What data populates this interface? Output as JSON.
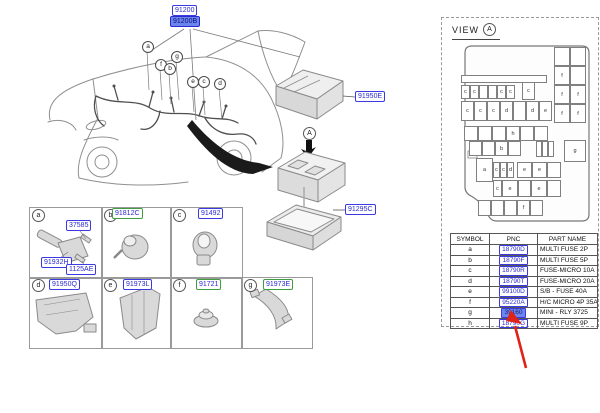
{
  "diagram": {
    "labels": {
      "main": "91200",
      "main_sub": "91200B",
      "main_sub_selected": true,
      "cover": "91950E",
      "lower_cover": "91295C"
    },
    "view_marker": "A",
    "car_callouts": [
      "a",
      "f",
      "b",
      "g",
      "e",
      "c",
      "d"
    ]
  },
  "parts_grid": {
    "cells": [
      {
        "letter": "a",
        "labels": [
          "37585",
          "91932H",
          "1125AE"
        ],
        "green": false
      },
      {
        "letter": "b",
        "labels": [
          "91812C"
        ],
        "green": true
      },
      {
        "letter": "c",
        "labels": [
          "91492"
        ],
        "green": false
      },
      {
        "letter": "d",
        "labels": [
          "91950Q"
        ],
        "green": false
      },
      {
        "letter": "e",
        "labels": [
          "91973L"
        ],
        "green": false
      },
      {
        "letter": "f",
        "labels": [
          "91721"
        ],
        "green": true
      },
      {
        "letter": "g",
        "labels": [
          "91973E"
        ],
        "green": true
      }
    ]
  },
  "view_panel": {
    "title": "VIEW",
    "marker": "A",
    "table": {
      "headers": [
        "SYMBOL",
        "PNC",
        "PART NAME"
      ],
      "rows": [
        {
          "symbol": "a",
          "pnc": "18790D",
          "part_name": "MULTI FUSE 2P",
          "selected": false
        },
        {
          "symbol": "b",
          "pnc": "18790F",
          "part_name": "MULTI FUSE 5P",
          "selected": false
        },
        {
          "symbol": "c",
          "pnc": "18790R",
          "part_name": "FUSE-MICRO 10A",
          "selected": false
        },
        {
          "symbol": "d",
          "pnc": "18790T",
          "part_name": "FUSE-MICRO 20A",
          "selected": false
        },
        {
          "symbol": "e",
          "pnc": "99100D",
          "part_name": "S/B - FUSE 40A",
          "selected": false
        },
        {
          "symbol": "f",
          "pnc": "95220A",
          "part_name": "H/C MICRO 4P 35A",
          "selected": false
        },
        {
          "symbol": "g",
          "pnc": "39160",
          "part_name": "MINI - RLY 3725",
          "selected": true
        },
        {
          "symbol": "h",
          "pnc": "18790G",
          "part_name": "MULTI FUSE 9P",
          "selected": false
        }
      ]
    },
    "fusebox": {
      "cells": [
        {
          "x": 100,
          "y": 2,
          "w": 16,
          "h": 19,
          "t": ""
        },
        {
          "x": 116,
          "y": 2,
          "w": 16,
          "h": 19,
          "t": ""
        },
        {
          "x": 100,
          "y": 21,
          "w": 16,
          "h": 19,
          "t": "f"
        },
        {
          "x": 116,
          "y": 21,
          "w": 16,
          "h": 19,
          "t": ""
        },
        {
          "x": 100,
          "y": 40,
          "w": 16,
          "h": 19,
          "t": "f"
        },
        {
          "x": 116,
          "y": 40,
          "w": 16,
          "h": 19,
          "t": "f"
        },
        {
          "x": 100,
          "y": 59,
          "w": 16,
          "h": 19,
          "t": "f"
        },
        {
          "x": 116,
          "y": 59,
          "w": 16,
          "h": 19,
          "t": "f"
        },
        {
          "x": 7,
          "y": 30,
          "w": 86,
          "h": 8,
          "t": ""
        },
        {
          "x": 7,
          "y": 40,
          "w": 9,
          "h": 14,
          "t": "c"
        },
        {
          "x": 16,
          "y": 40,
          "w": 9,
          "h": 14,
          "t": "c"
        },
        {
          "x": 25,
          "y": 40,
          "w": 9,
          "h": 14,
          "t": ""
        },
        {
          "x": 34,
          "y": 40,
          "w": 9,
          "h": 14,
          "t": ""
        },
        {
          "x": 43,
          "y": 40,
          "w": 9,
          "h": 14,
          "t": "c"
        },
        {
          "x": 52,
          "y": 40,
          "w": 9,
          "h": 14,
          "t": "c"
        },
        {
          "x": 68,
          "y": 37,
          "w": 13,
          "h": 18,
          "t": "c"
        },
        {
          "x": 7,
          "y": 56,
          "w": 13,
          "h": 20,
          "t": "c"
        },
        {
          "x": 20,
          "y": 56,
          "w": 13,
          "h": 20,
          "t": "c"
        },
        {
          "x": 33,
          "y": 56,
          "w": 13,
          "h": 20,
          "t": "c"
        },
        {
          "x": 46,
          "y": 56,
          "w": 13,
          "h": 20,
          "t": "d"
        },
        {
          "x": 59,
          "y": 56,
          "w": 13,
          "h": 20,
          "t": ""
        },
        {
          "x": 72,
          "y": 56,
          "w": 13,
          "h": 20,
          "t": "d"
        },
        {
          "x": 85,
          "y": 56,
          "w": 13,
          "h": 20,
          "t": "e"
        },
        {
          "x": 10,
          "y": 81,
          "w": 14,
          "h": 15,
          "t": ""
        },
        {
          "x": 24,
          "y": 81,
          "w": 14,
          "h": 15,
          "t": ""
        },
        {
          "x": 38,
          "y": 81,
          "w": 14,
          "h": 15,
          "t": ""
        },
        {
          "x": 52,
          "y": 81,
          "w": 14,
          "h": 15,
          "t": "h"
        },
        {
          "x": 66,
          "y": 81,
          "w": 14,
          "h": 15,
          "t": ""
        },
        {
          "x": 80,
          "y": 81,
          "w": 14,
          "h": 15,
          "t": ""
        },
        {
          "x": 15,
          "y": 96,
          "w": 13,
          "h": 15,
          "t": ""
        },
        {
          "x": 28,
          "y": 96,
          "w": 13,
          "h": 15,
          "t": ""
        },
        {
          "x": 41,
          "y": 96,
          "w": 13,
          "h": 15,
          "t": "b"
        },
        {
          "x": 54,
          "y": 96,
          "w": 13,
          "h": 15,
          "t": ""
        },
        {
          "x": 82,
          "y": 96,
          "w": 6,
          "h": 16,
          "t": ""
        },
        {
          "x": 88,
          "y": 96,
          "w": 6,
          "h": 16,
          "t": ""
        },
        {
          "x": 94,
          "y": 96,
          "w": 6,
          "h": 16,
          "t": ""
        },
        {
          "x": 110,
          "y": 95,
          "w": 22,
          "h": 22,
          "t": "g"
        },
        {
          "x": 22,
          "y": 113,
          "w": 17,
          "h": 24,
          "t": "a"
        },
        {
          "x": 39,
          "y": 117,
          "w": 7,
          "h": 16,
          "t": "c"
        },
        {
          "x": 46,
          "y": 117,
          "w": 7,
          "h": 16,
          "t": "c"
        },
        {
          "x": 53,
          "y": 117,
          "w": 7,
          "h": 16,
          "t": "d"
        },
        {
          "x": 63,
          "y": 117,
          "w": 15,
          "h": 16,
          "t": "e"
        },
        {
          "x": 78,
          "y": 117,
          "w": 15,
          "h": 16,
          "t": "e"
        },
        {
          "x": 93,
          "y": 117,
          "w": 14,
          "h": 16,
          "t": ""
        },
        {
          "x": 39,
          "y": 135,
          "w": 9,
          "h": 17,
          "t": "c"
        },
        {
          "x": 48,
          "y": 135,
          "w": 16,
          "h": 17,
          "t": "e"
        },
        {
          "x": 64,
          "y": 135,
          "w": 13,
          "h": 17,
          "t": ""
        },
        {
          "x": 77,
          "y": 135,
          "w": 16,
          "h": 17,
          "t": "e"
        },
        {
          "x": 93,
          "y": 135,
          "w": 14,
          "h": 17,
          "t": ""
        },
        {
          "x": 24,
          "y": 155,
          "w": 13,
          "h": 16,
          "t": ""
        },
        {
          "x": 37,
          "y": 155,
          "w": 13,
          "h": 16,
          "t": ""
        },
        {
          "x": 50,
          "y": 155,
          "w": 13,
          "h": 16,
          "t": ""
        },
        {
          "x": 63,
          "y": 155,
          "w": 13,
          "h": 16,
          "t": "f"
        },
        {
          "x": 76,
          "y": 155,
          "w": 13,
          "h": 16,
          "t": ""
        }
      ]
    }
  },
  "colors": {
    "label_blue": "#2a2ad0",
    "label_green": "#3f9e3f",
    "selection_fill": "#6c86ee",
    "arrow_red": "#e02318"
  }
}
